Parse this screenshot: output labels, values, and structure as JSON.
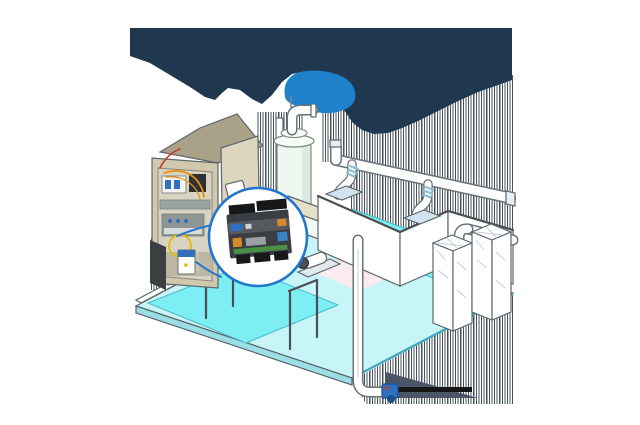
{
  "illustration": {
    "backdrop": {
      "navy": "#1f3850",
      "blob_blue": "#1e81c9"
    },
    "callout": {
      "ring": "#2277cc",
      "bg": "#ffffff"
    },
    "controller": {
      "body": "#3a3d42",
      "panel": "#56595e",
      "label_blue": "#2f6fbe",
      "label_white": "#cfd4d8",
      "label_orange": "#d78a2a",
      "connector_orange": "#d78a2a",
      "connector_gray": "#9aa0a6",
      "connector_blue": "#3b82c4",
      "pcb_green": "#4a8f46",
      "terminal_black": "#17181a"
    },
    "cabinet": {
      "shell": "#cfc8ac",
      "shell_top": "#a9a289",
      "door": "#ddd6bc",
      "interior": "#d8d4c4",
      "interior_shade": "#bcb7a4",
      "breaker_white": "#f2f3f0",
      "toggle_blue": "#2f6fbe",
      "contactor_black": "#2e3133",
      "duct_gray": "#9aa49f",
      "relay_gray": "#8f9794",
      "relay_strip": "#d7dbd9",
      "wire_orange": "#e8920f",
      "wire_yellow": "#e8b90f",
      "wire_red": "#c63b2a",
      "pocket_white": "#ffffff",
      "under_shade": "#3c3f41"
    },
    "room": {
      "floor_light": "#c8f5f7",
      "pool_cyan": "#7deef3",
      "slab": "#9adfe6",
      "edge_teal": "#3aa9bd",
      "wall_white": "#ffffff",
      "wall_tan": "#e6dfc8",
      "wall_mint": "#f3faf4",
      "floor_pink": "#fbeaee",
      "dot_dark": "#3a3f45"
    },
    "equipment": {
      "vessel_body": "#eef7f0",
      "vessel_collar": "#f7fcf7",
      "vessel_shade": "#dcebe0",
      "pipe_white": "#ffffff",
      "flange_blue": "#cfe4ef",
      "coupling_blue": "#8fc0dc",
      "hub_dark": "#4a4f52",
      "plinth": "#dfe9ee",
      "duct_cap": "#e8eef1",
      "pump_blue": "#2f6fbe",
      "pump_dark": "#1c4f8e",
      "pump_red": "#c63b2a",
      "shadow_slate": "#4a5568",
      "shadow_black": "#151515",
      "sensor_blue": "#2f6fbe",
      "sensor_dot": "#e8b90f",
      "sensor_side": "#c9c4b2",
      "leader_blue": "#2277cc"
    },
    "artifact_stripe": "#26343d"
  }
}
